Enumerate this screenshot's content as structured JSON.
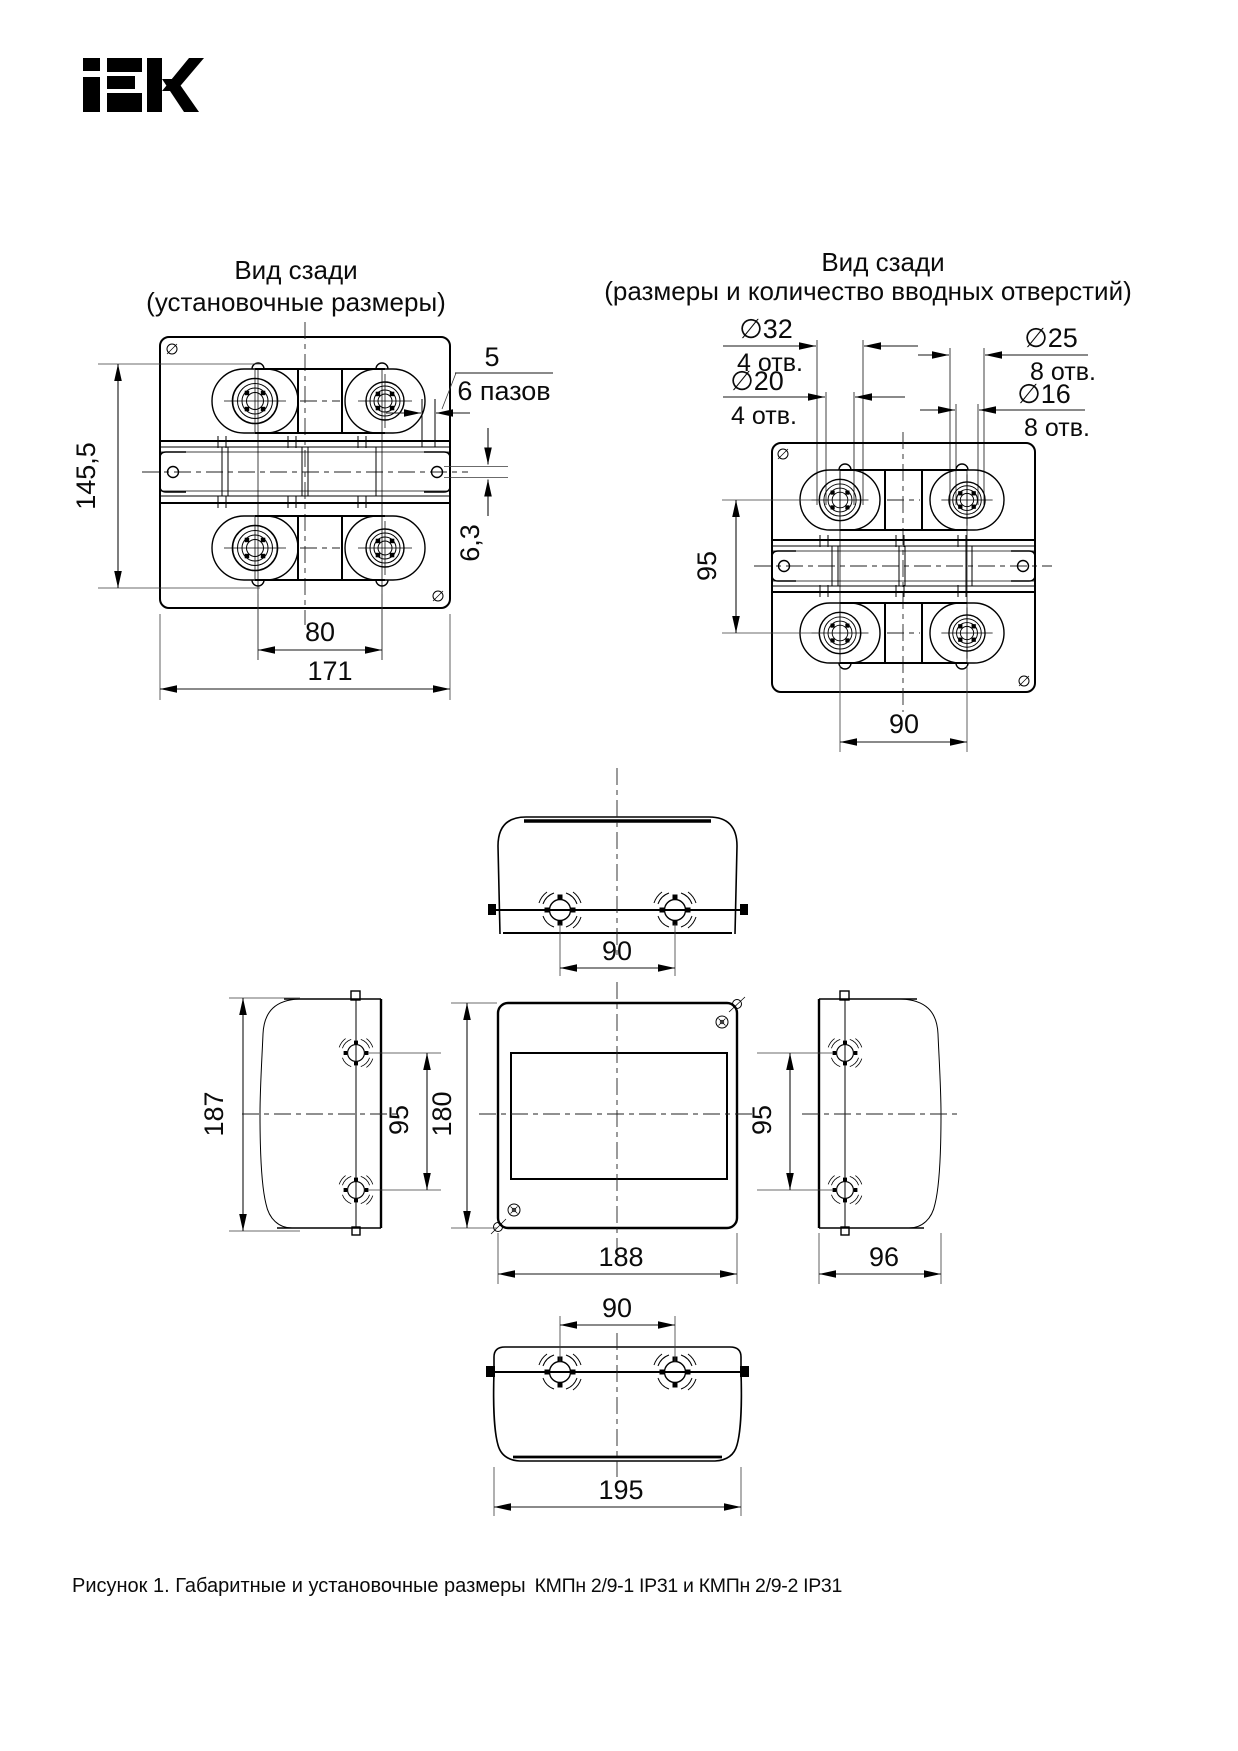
{
  "logo": {
    "alt": "IEK"
  },
  "rear_install_view": {
    "title1": "Вид сзади",
    "title2": "(установочные размеры)",
    "dim_height": "145,5",
    "dim_slot_width": "5",
    "slot_count_label": "6 пазов",
    "dim_slot_depth": "6,3",
    "dim_hole_spacing": "80",
    "dim_width": "171"
  },
  "rear_holes_view": {
    "title1": "Вид сзади",
    "title2": "(размеры и количество вводных отверстий)",
    "d32": "∅32",
    "d32_qty": "4 отв.",
    "d20": "∅20",
    "d20_qty": "4 отв.",
    "d25": "∅25",
    "d25_qty": "8 отв.",
    "d16": "∅16",
    "d16_qty": "8 отв.",
    "dim_v": "95",
    "dim_h": "90"
  },
  "top_view": {
    "dim_holes": "90"
  },
  "left_view": {
    "dim_height": "187",
    "dim_holes": "95"
  },
  "front_view": {
    "dim_height": "180",
    "dim_width": "188"
  },
  "right_view": {
    "dim_holes": "95",
    "dim_depth": "96"
  },
  "bottom_view": {
    "dim_holes": "90",
    "dim_width": "195"
  },
  "caption": {
    "figure": "Рисунок 1. Габаритные и установочные размеры",
    "models": "КМПн 2/9-1 IP31 и КМПн 2/9-2 IP31"
  }
}
